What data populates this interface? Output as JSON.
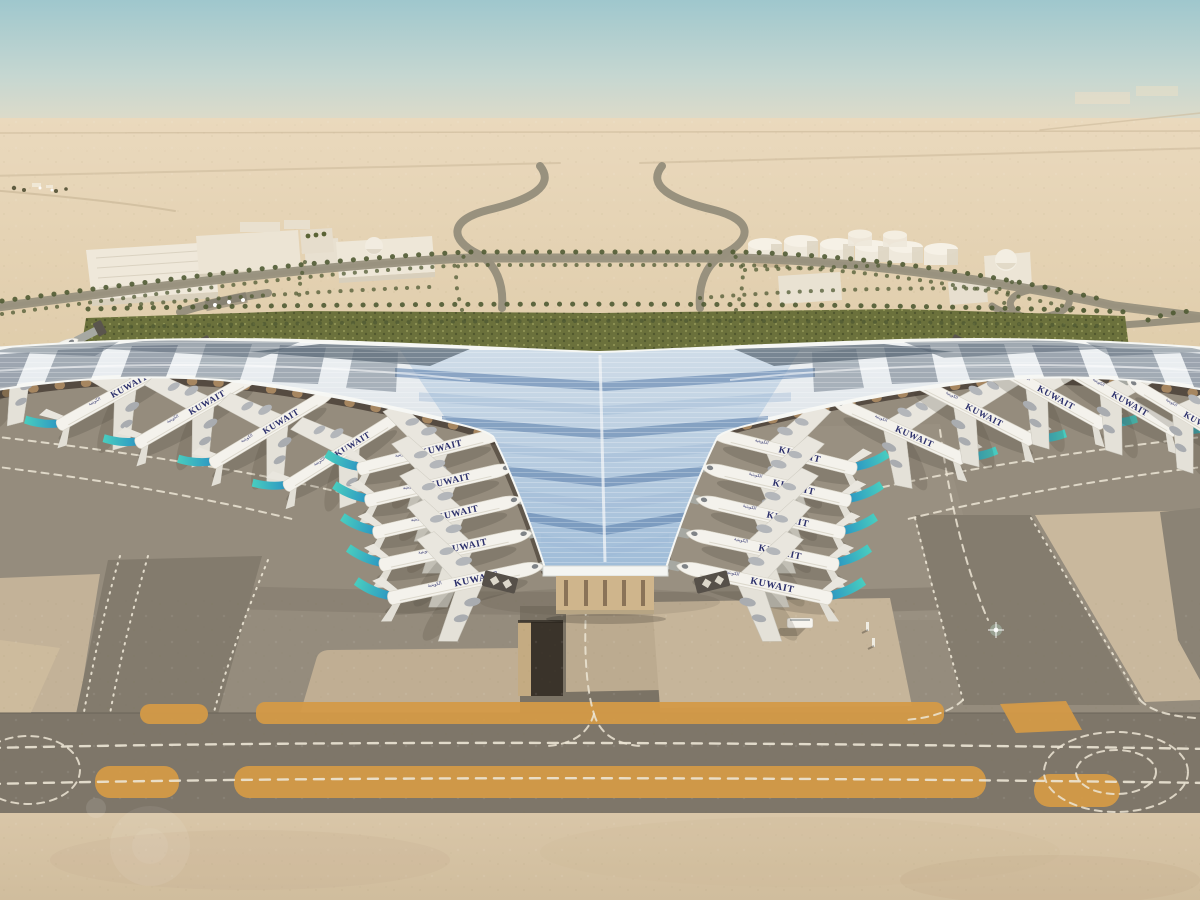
{
  "scene": {
    "title": "Kuwait International Airport new terminal — aerial architectural rendering",
    "environment": "desert airport with palm-lined approach roads, fuel tank farm, trident-shaped terminal roof, parked airliners, taxiways"
  },
  "airline": {
    "wordmark": "KUWAIT",
    "script": "الكويتية"
  },
  "colors": {
    "sky_top": "#9fc7cd",
    "sky_haze": "#e7dcc5",
    "desert": "#e4d2b4",
    "sand": "#d8c5a7",
    "green": "#6b713c",
    "palm": "#4f5a33",
    "roof_light": "#eef1f3",
    "roof_glass": "#9db6cf",
    "roof_dark": "#5a6878",
    "canopy_shadow": "#4a4036",
    "column": "#c19a6b",
    "fuselage": "#f4f2ec",
    "fin_teal": "#49cdbf",
    "fin_blue": "#2a5fa8",
    "navy": "#2b2f6b",
    "apron": "#958c7d",
    "taxiway": "#7e7669",
    "concrete_light": "#c6b59a",
    "ochre": "#d49a47",
    "marking": "#ece5d5",
    "pit": "#3a332a"
  },
  "aircraft": {
    "count": 20,
    "fleet": [
      {
        "x": 14,
        "y": 372,
        "rot": -27,
        "s": 0.9,
        "m": false
      },
      {
        "x": 118,
        "y": 393,
        "rot": -29,
        "s": 0.95,
        "m": false
      },
      {
        "x": 196,
        "y": 410,
        "rot": -30,
        "s": 0.95,
        "m": false
      },
      {
        "x": 270,
        "y": 429,
        "rot": -31,
        "s": 0.95,
        "m": false
      },
      {
        "x": 342,
        "y": 452,
        "rot": -32,
        "s": 0.93,
        "m": false
      },
      {
        "x": 428,
        "y": 452,
        "rot": -14,
        "s": 1.0,
        "m": false
      },
      {
        "x": 436,
        "y": 485,
        "rot": -13,
        "s": 1.0,
        "m": false
      },
      {
        "x": 444,
        "y": 517,
        "rot": -13,
        "s": 1.0,
        "m": false
      },
      {
        "x": 452,
        "y": 550,
        "rot": -12,
        "s": 1.02,
        "m": false
      },
      {
        "x": 462,
        "y": 583,
        "rot": -12,
        "s": 1.04,
        "m": false
      },
      {
        "x": 786,
        "y": 452,
        "rot": 14,
        "s": 1.0,
        "m": true
      },
      {
        "x": 780,
        "y": 485,
        "rot": 13,
        "s": 1.0,
        "m": true
      },
      {
        "x": 774,
        "y": 517,
        "rot": 13,
        "s": 1.0,
        "m": true
      },
      {
        "x": 766,
        "y": 550,
        "rot": 12,
        "s": 1.02,
        "m": true
      },
      {
        "x": 758,
        "y": 583,
        "rot": 12,
        "s": 1.04,
        "m": true
      },
      {
        "x": 902,
        "y": 432,
        "rot": 24,
        "s": 0.95,
        "m": true
      },
      {
        "x": 972,
        "y": 410,
        "rot": 27,
        "s": 0.95,
        "m": true
      },
      {
        "x": 1044,
        "y": 392,
        "rot": 29,
        "s": 0.95,
        "m": true
      },
      {
        "x": 1118,
        "y": 398,
        "rot": 30,
        "s": 0.95,
        "m": true
      },
      {
        "x": 1190,
        "y": 418,
        "rot": 31,
        "s": 0.92,
        "m": true
      }
    ]
  }
}
